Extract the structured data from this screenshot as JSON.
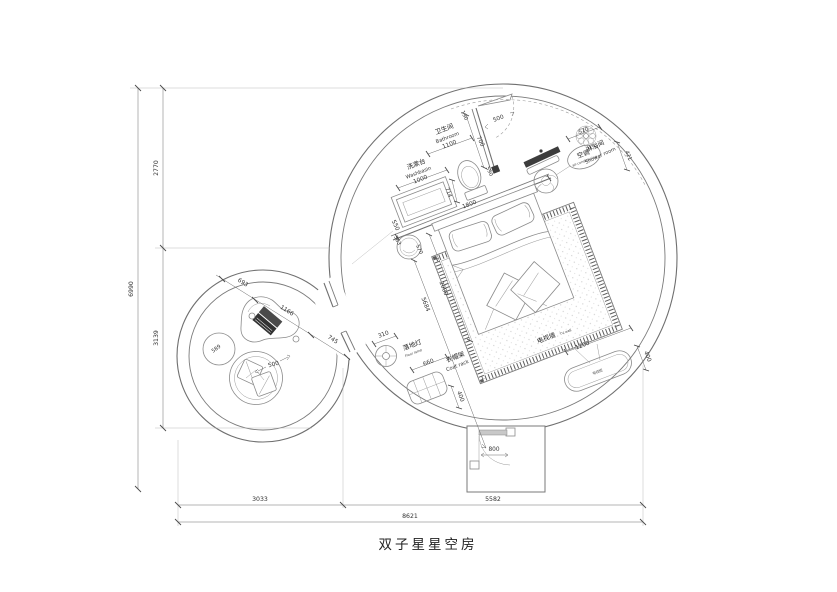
{
  "title": "双子星星空房",
  "rooms": {
    "washbasin_zh": "洗漱台",
    "washbasin_en": "Washbasin",
    "bathroom_zh": "卫生间",
    "bathroom_en": "Bathroom",
    "shower_zh": "淋浴间",
    "shower_en": "Shower room",
    "ac_zh": "空调",
    "ac_en": "air-conditioning",
    "floorlamp_zh": "落地灯",
    "floorlamp_en": "Floor lamp",
    "coatrack_zh": "衣帽架",
    "coatrack_en": "Coat rack",
    "tvwall_zh": "电视墙",
    "tvwall_en": "TV wall",
    "tvcab_zh": "电视柜"
  },
  "dims": {
    "overall_h": "6990",
    "upper_h": "2770",
    "lower_h": "3139",
    "left_w": "3033",
    "right_w": "5582",
    "overall_w": "8621",
    "washbasin": "1000",
    "washbasin_depth": "550",
    "bathroom": "1100",
    "gap190": "190",
    "wall700": "700",
    "showerdoor500": "500",
    "wallend590": "590",
    "toilet714": "714",
    "bedwall1800": "1800",
    "stool383": "383",
    "stool570": "570",
    "bed2000": "2000",
    "diag5684": "5684",
    "lamp310": "310",
    "coatrack660": "660",
    "coatrack400": "400",
    "ac520": "520",
    "ac421": "421",
    "tv1200": "1200",
    "tv400": "400",
    "door800": "800",
    "left693": "693",
    "left1166": "1166",
    "left745": "745",
    "pouf589": "589",
    "chair500": "500"
  },
  "colors": {
    "line": "#6f6f6f",
    "dim": "#4a4a4a",
    "dark_fill": "#3c3c3c",
    "paper": "#ffffff"
  }
}
